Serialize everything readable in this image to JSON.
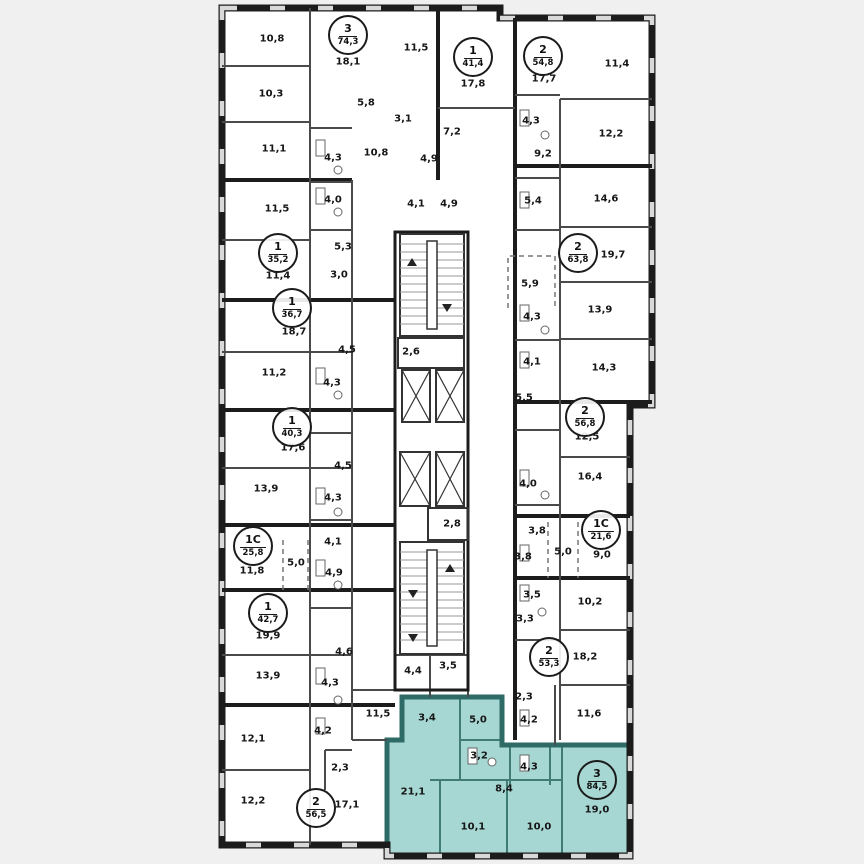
{
  "plan": {
    "description": "Residential floor plan with highlighted 3-room apartment",
    "colors": {
      "background": "#f0f0f0",
      "paper": "#ffffff",
      "wall": "#1c1c1c",
      "inner_wall": "#4a4a4a",
      "highlight_fill": "#a7d7d2",
      "highlight_wall": "#2f6b66"
    },
    "room_labels": [
      {
        "text": "10,8",
        "x": 272,
        "y": 39
      },
      {
        "text": "11,5",
        "x": 416,
        "y": 48
      },
      {
        "text": "18,1",
        "x": 348,
        "y": 62
      },
      {
        "text": "10,3",
        "x": 271,
        "y": 94
      },
      {
        "text": "5,8",
        "x": 366,
        "y": 103
      },
      {
        "text": "3,1",
        "x": 403,
        "y": 119
      },
      {
        "text": "11,1",
        "x": 274,
        "y": 149
      },
      {
        "text": "4,3",
        "x": 333,
        "y": 158
      },
      {
        "text": "10,8",
        "x": 376,
        "y": 153
      },
      {
        "text": "4,9",
        "x": 429,
        "y": 159
      },
      {
        "text": "4,0",
        "x": 333,
        "y": 200
      },
      {
        "text": "4,1",
        "x": 416,
        "y": 204
      },
      {
        "text": "4,9",
        "x": 449,
        "y": 204
      },
      {
        "text": "11,5",
        "x": 277,
        "y": 209
      },
      {
        "text": "5,3",
        "x": 343,
        "y": 247
      },
      {
        "text": "11,4",
        "x": 278,
        "y": 276
      },
      {
        "text": "3,0",
        "x": 339,
        "y": 275
      },
      {
        "text": "18,7",
        "x": 294,
        "y": 332
      },
      {
        "text": "2,6",
        "x": 411,
        "y": 352
      },
      {
        "text": "4,5",
        "x": 347,
        "y": 350
      },
      {
        "text": "11,2",
        "x": 274,
        "y": 373
      },
      {
        "text": "4,3",
        "x": 332,
        "y": 383
      },
      {
        "text": "17,6",
        "x": 293,
        "y": 448
      },
      {
        "text": "4,5",
        "x": 343,
        "y": 466
      },
      {
        "text": "13,9",
        "x": 266,
        "y": 489
      },
      {
        "text": "4,3",
        "x": 333,
        "y": 498
      },
      {
        "text": "2,8",
        "x": 452,
        "y": 524
      },
      {
        "text": "4,1",
        "x": 333,
        "y": 542
      },
      {
        "text": "5,0",
        "x": 296,
        "y": 563
      },
      {
        "text": "11,8",
        "x": 252,
        "y": 571
      },
      {
        "text": "4,9",
        "x": 334,
        "y": 573
      },
      {
        "text": "19,9",
        "x": 268,
        "y": 636
      },
      {
        "text": "4,6",
        "x": 344,
        "y": 652
      },
      {
        "text": "13,9",
        "x": 268,
        "y": 676
      },
      {
        "text": "4,3",
        "x": 330,
        "y": 683
      },
      {
        "text": "4,4",
        "x": 413,
        "y": 671
      },
      {
        "text": "3,5",
        "x": 448,
        "y": 666
      },
      {
        "text": "11,5",
        "x": 378,
        "y": 714
      },
      {
        "text": "12,1",
        "x": 253,
        "y": 739
      },
      {
        "text": "4,2",
        "x": 323,
        "y": 731
      },
      {
        "text": "2,3",
        "x": 340,
        "y": 768
      },
      {
        "text": "12,2",
        "x": 253,
        "y": 801
      },
      {
        "text": "17,1",
        "x": 347,
        "y": 805
      },
      {
        "text": "17,8",
        "x": 473,
        "y": 84
      },
      {
        "text": "17,7",
        "x": 544,
        "y": 79
      },
      {
        "text": "11,4",
        "x": 617,
        "y": 64
      },
      {
        "text": "7,2",
        "x": 452,
        "y": 132
      },
      {
        "text": "4,3",
        "x": 531,
        "y": 121
      },
      {
        "text": "12,2",
        "x": 611,
        "y": 134
      },
      {
        "text": "9,2",
        "x": 543,
        "y": 154
      },
      {
        "text": "5,4",
        "x": 533,
        "y": 201
      },
      {
        "text": "14,6",
        "x": 606,
        "y": 199
      },
      {
        "text": "19,7",
        "x": 613,
        "y": 255
      },
      {
        "text": "5,9",
        "x": 530,
        "y": 284
      },
      {
        "text": "13,9",
        "x": 600,
        "y": 310
      },
      {
        "text": "4,3",
        "x": 532,
        "y": 317
      },
      {
        "text": "4,1",
        "x": 532,
        "y": 362
      },
      {
        "text": "14,3",
        "x": 604,
        "y": 368
      },
      {
        "text": "5,5",
        "x": 524,
        "y": 398
      },
      {
        "text": "12,5",
        "x": 587,
        "y": 437
      },
      {
        "text": "16,4",
        "x": 590,
        "y": 477
      },
      {
        "text": "4,0",
        "x": 528,
        "y": 484
      },
      {
        "text": "3,8",
        "x": 537,
        "y": 531
      },
      {
        "text": "3,8",
        "x": 523,
        "y": 557
      },
      {
        "text": "5,0",
        "x": 563,
        "y": 552
      },
      {
        "text": "9,0",
        "x": 602,
        "y": 555
      },
      {
        "text": "3,5",
        "x": 532,
        "y": 595
      },
      {
        "text": "10,2",
        "x": 590,
        "y": 602
      },
      {
        "text": "3,3",
        "x": 525,
        "y": 619
      },
      {
        "text": "18,2",
        "x": 585,
        "y": 657
      },
      {
        "text": "2,3",
        "x": 524,
        "y": 697
      },
      {
        "text": "4,2",
        "x": 529,
        "y": 720
      },
      {
        "text": "11,6",
        "x": 589,
        "y": 714
      },
      {
        "text": "3,4",
        "x": 427,
        "y": 718
      },
      {
        "text": "5,0",
        "x": 478,
        "y": 720
      },
      {
        "text": "3,2",
        "x": 479,
        "y": 756
      },
      {
        "text": "4,3",
        "x": 529,
        "y": 767
      },
      {
        "text": "8,4",
        "x": 504,
        "y": 789
      },
      {
        "text": "21,1",
        "x": 413,
        "y": 792
      },
      {
        "text": "19,0",
        "x": 597,
        "y": 810
      },
      {
        "text": "10,1",
        "x": 473,
        "y": 827
      },
      {
        "text": "10,0",
        "x": 539,
        "y": 827
      }
    ],
    "apartment_badges": [
      {
        "type": "3",
        "area": "74,3",
        "x": 348,
        "y": 35,
        "highlighted": false
      },
      {
        "type": "1",
        "area": "41,4",
        "x": 473,
        "y": 57,
        "highlighted": false
      },
      {
        "type": "2",
        "area": "54,8",
        "x": 543,
        "y": 56,
        "highlighted": false
      },
      {
        "type": "1",
        "area": "35,2",
        "x": 278,
        "y": 253,
        "highlighted": false
      },
      {
        "type": "2",
        "area": "63,8",
        "x": 578,
        "y": 253,
        "highlighted": false
      },
      {
        "type": "1",
        "area": "36,7",
        "x": 292,
        "y": 308,
        "highlighted": false
      },
      {
        "type": "1",
        "area": "40,3",
        "x": 292,
        "y": 427,
        "highlighted": false
      },
      {
        "type": "2",
        "area": "56,8",
        "x": 585,
        "y": 417,
        "highlighted": false
      },
      {
        "type": "1C",
        "area": "25,8",
        "x": 253,
        "y": 546,
        "highlighted": false
      },
      {
        "type": "1C",
        "area": "21,6",
        "x": 601,
        "y": 530,
        "highlighted": false
      },
      {
        "type": "1",
        "area": "42,7",
        "x": 268,
        "y": 613,
        "highlighted": false
      },
      {
        "type": "2",
        "area": "53,3",
        "x": 549,
        "y": 657,
        "highlighted": false
      },
      {
        "type": "2",
        "area": "56,5",
        "x": 316,
        "y": 808,
        "highlighted": false
      },
      {
        "type": "3",
        "area": "84,5",
        "x": 597,
        "y": 780,
        "highlighted": true
      }
    ]
  }
}
